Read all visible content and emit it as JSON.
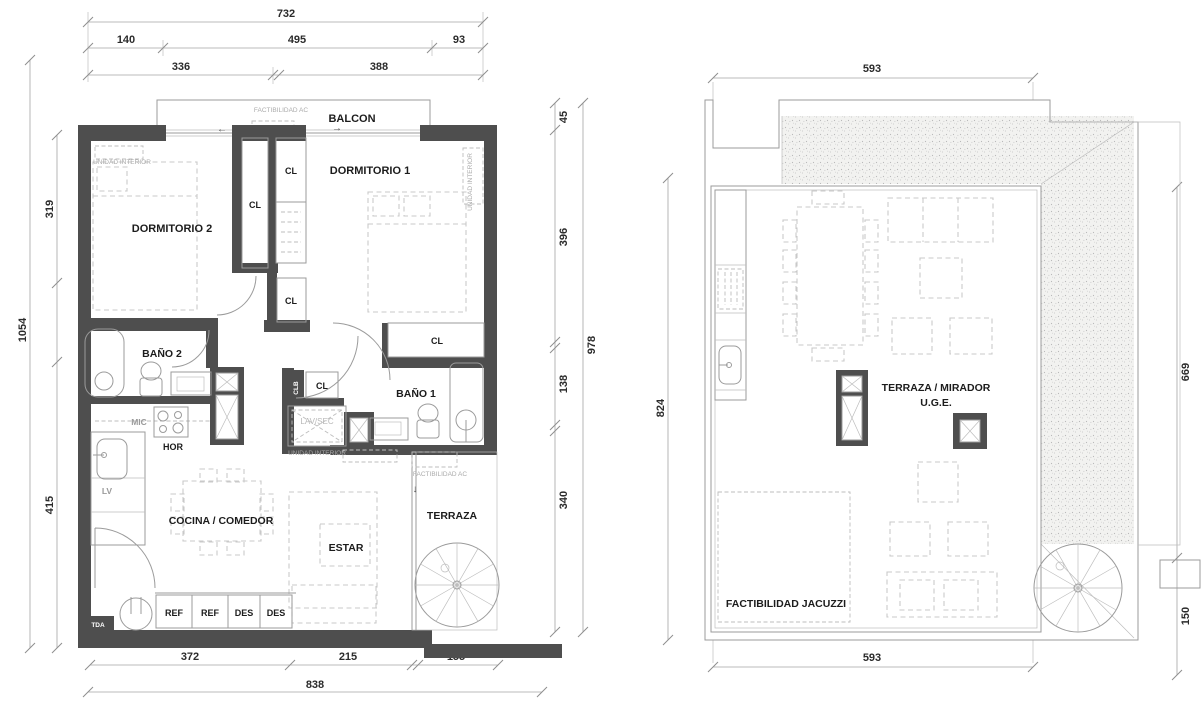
{
  "drawing": {
    "background": "#ffffff",
    "wall_color": "#4e4e4e",
    "line_color": "#9b9b9b",
    "furniture_dash_color": "#c9c9c9",
    "text_color": "#1c1c1c",
    "muted_text_color": "#ababab"
  },
  "left_plan": {
    "rooms": {
      "balcon": "BALCON",
      "dormitorio1": "DORMITORIO 1",
      "dormitorio2": "DORMITORIO 2",
      "bano1": "BAÑO 1",
      "bano2": "BAÑO 2",
      "cocina_comedor": "COCINA / COMEDOR",
      "estar": "ESTAR",
      "terraza": "TERRAZA"
    },
    "closets": {
      "cl_tall": "CL",
      "cl_top": "CL",
      "cl_lower": "CL",
      "cl_bano1": "CL",
      "cl_lavsec": "CL",
      "cl_small": "CLB"
    },
    "fixtures": {
      "mic": "MIC",
      "hor": "HOR",
      "lav_sec": "LAV/SEC",
      "lv": "LV",
      "tda": "TDA",
      "ref1": "REF",
      "ref2": "REF",
      "des1": "DES",
      "des2": "DES"
    },
    "annotations": {
      "factibilidad_ac_balcon": "FACTIBILIDAD AC",
      "factibilidad_ac_terraza": "FACTIBILIDAD AC",
      "unidad_interior_dorm2": "UNIDAD INTERIOR",
      "unidad_interior_dorm1": "UNIDAD INTERIOR",
      "unidad_interior_estar": "UNIDAD INTERIOR",
      "arrow_left": "←",
      "arrow_right": "→",
      "arrow_down": "↓"
    },
    "dimensions": {
      "top_total": "732",
      "top_a": "140",
      "top_b": "495",
      "top_c": "93",
      "top_d": "336",
      "top_e": "388",
      "left_total": "1054",
      "left_a": "319",
      "left_b": "415",
      "right_a": "45",
      "right_b": "396",
      "right_c": "138",
      "right_d": "340",
      "right_total": "978",
      "bottom_a": "372",
      "bottom_b": "215",
      "bottom_c": "155",
      "bottom_total": "838"
    }
  },
  "right_plan": {
    "rooms": {
      "terraza_mirador": "TERRAZA / MIRADOR",
      "uge": "U.G.E."
    },
    "annotations": {
      "factibilidad_jacuzzi": "FACTIBILIDAD JACUZZI"
    },
    "dimensions": {
      "top_total": "593",
      "bottom_total": "593",
      "left_total": "824",
      "right_a": "669",
      "right_b": "150"
    }
  }
}
